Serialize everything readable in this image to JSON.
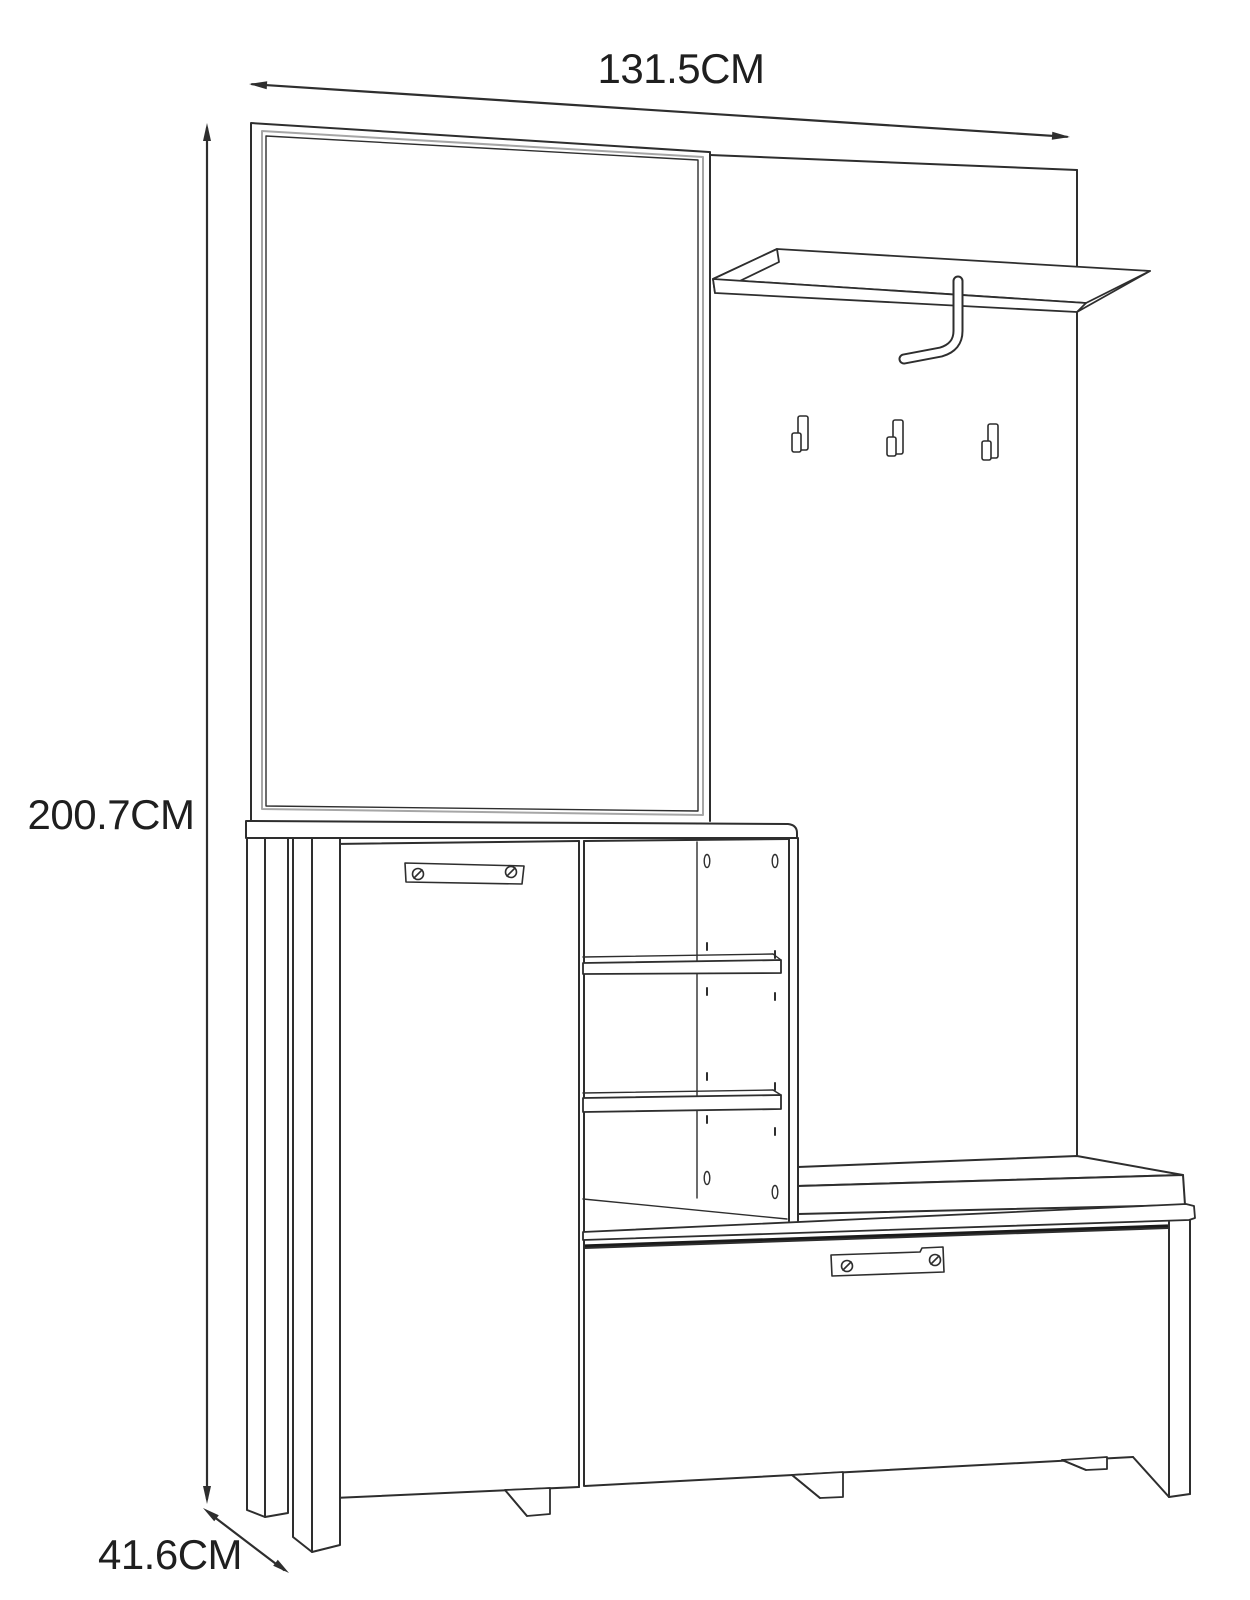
{
  "diagram": {
    "kind": "furniture-dimension-drawing",
    "dimensions": {
      "width": "131.5CM",
      "height": "200.7CM",
      "depth": "41.6CM"
    },
    "colors": {
      "line": "#2e2e2e",
      "line_soft": "#a6a6a6",
      "line_dark": "#1a1a1a",
      "background": "#ffffff",
      "text": "#1f1f1f"
    }
  }
}
